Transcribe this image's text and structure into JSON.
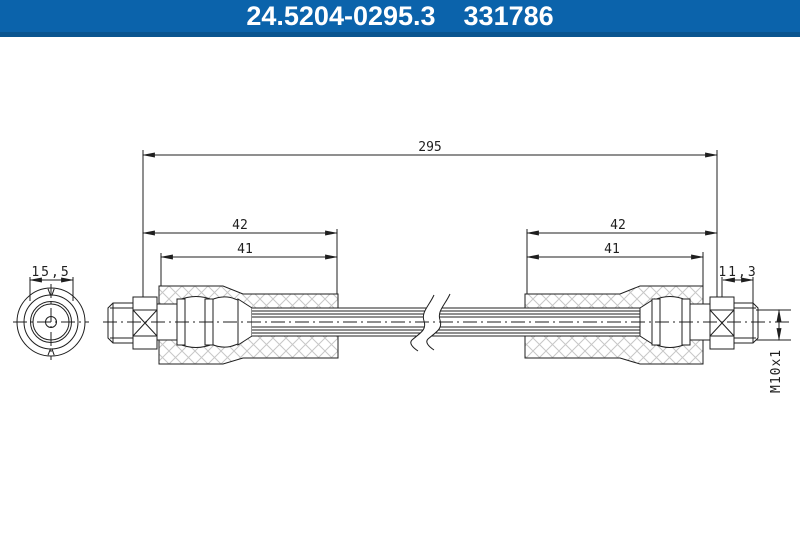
{
  "header": {
    "part_number": "24.5204-0295.3",
    "catalog_number": "331786"
  },
  "drawing": {
    "dimensions": {
      "overall_length": "295",
      "left_end_to_sleeve": "42",
      "left_sleeve_length": "41",
      "right_end_to_sleeve": "42",
      "right_sleeve_length": "41",
      "end_fitting_diameter": "15,5",
      "thread_length": "11,3",
      "thread_spec": "M10x1"
    }
  },
  "colors": {
    "header_bg": "#0b63ab",
    "header_edge": "#0a5590",
    "header_text": "#ffffff",
    "line": "#1f1f1f",
    "hatch": "#c7c7c7",
    "bg": "#ffffff"
  }
}
